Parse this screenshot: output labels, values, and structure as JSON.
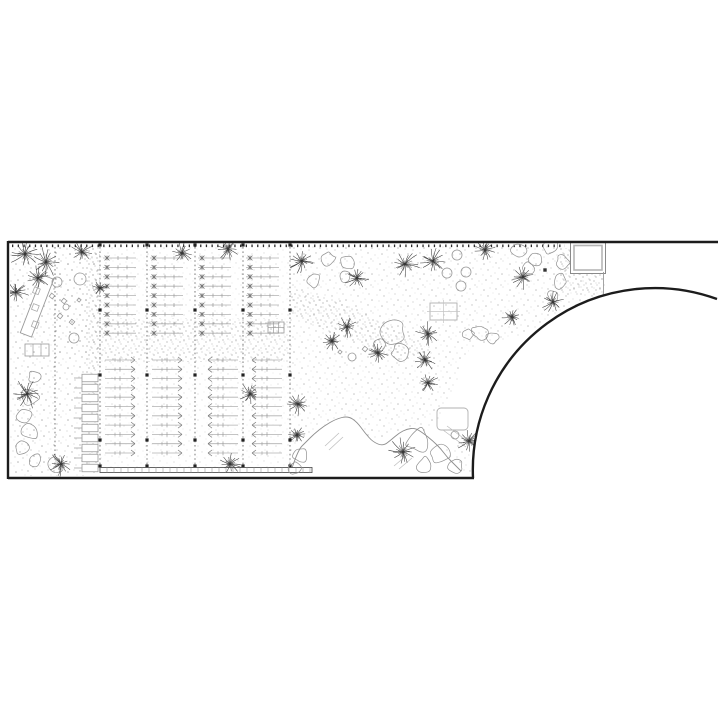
{
  "meta": {
    "description": "monochrome landscape architecture site plan, line drawing, no text labels",
    "canvas": {
      "w": 720,
      "h": 720
    },
    "colors": {
      "background": "#ffffff",
      "boundary": "#1c1c1c",
      "line_mid": "#5a5a5a",
      "line_light": "#9a9a9a",
      "twig": "#b0b0b0",
      "tree": "#3c3c3c",
      "cloud": "#8f8f8f",
      "stipple": "#4a4a4a",
      "structure": "#9a9a9a"
    }
  },
  "plan": {
    "boundary": {
      "stroke_width": 2.4,
      "top": {
        "x1": 8,
        "y1": 242,
        "x2": 718,
        "y2": 242
      },
      "left": {
        "x1": 8,
        "y1": 241,
        "x2": 8,
        "y2": 479
      },
      "bottom": {
        "x1": 8,
        "y1": 478,
        "x2": 474,
        "y2": 478
      },
      "arc_path": "M473,478 A182 182 0 0 1 717,299",
      "clip_path": "M10,243 L717,243 L717,298 A182 182 0 0 0 473,477 L10,477 Z"
    },
    "tick_lines": [
      {
        "x1": 12,
        "y": 245.8,
        "x2": 565
      },
      {
        "x1": 12,
        "y": 480.6,
        "x2": 465
      }
    ],
    "guide_lines": {
      "xs": [
        55,
        100,
        147,
        195,
        243,
        290
      ],
      "y1": 247,
      "y2": 467
    },
    "line_nodes": {
      "xs": [
        100,
        147,
        195,
        243,
        290
      ],
      "ys": [
        245,
        310,
        375,
        440,
        466
      ]
    },
    "plant_rows_upper": {
      "y_start": 258,
      "rows": 9,
      "step": 9.4,
      "len": 33,
      "cols": [
        {
          "x": 103
        },
        {
          "x": 150
        },
        {
          "x": 198
        },
        {
          "x": 246
        }
      ]
    },
    "plant_rows_lower": {
      "y_start": 360,
      "rows": 11,
      "step": 9.3,
      "len": 30,
      "cols": [
        {
          "x": 105,
          "dir": 1
        },
        {
          "x": 152,
          "dir": 1
        },
        {
          "x": 208,
          "dir": -1
        },
        {
          "x": 252,
          "dir": -1
        }
      ]
    },
    "planter_boxes": {
      "x": 82,
      "w": 16,
      "h": 7.5,
      "y_start": 378,
      "count": 10,
      "step": 10,
      "stem": 8
    },
    "boardwalk": {
      "x": 100,
      "y": 467.5,
      "w": 212,
      "h": 5,
      "tick_step": 7
    },
    "square_structure": {
      "x": 572,
      "y": 243.5,
      "w": 32,
      "h": 28.5,
      "drop_x": 603.5,
      "drop_y1": 272,
      "drop_y2": 295
    },
    "ramp": {
      "cx": 37,
      "cy": 306,
      "w": 12,
      "len": 62,
      "angle": 21,
      "inner_squares": [
        [
          31,
          292
        ],
        [
          36,
          308
        ],
        [
          42,
          324
        ]
      ]
    },
    "grids": [
      {
        "x": 25,
        "y": 344,
        "w": 24,
        "h": 12,
        "cols": 3,
        "rows": 1
      },
      {
        "x": 268,
        "y": 322,
        "w": 16,
        "h": 11,
        "cols": 3,
        "rows": 2
      }
    ],
    "rects": [
      {
        "x": 430,
        "y": 303,
        "w": 27,
        "h": 17,
        "cross": true,
        "rx": 0
      },
      {
        "x": 437,
        "y": 408,
        "w": 31,
        "h": 22,
        "cross": false,
        "rx": 4
      }
    ],
    "trees": [
      [
        25,
        254,
        13
      ],
      [
        46,
        262,
        12
      ],
      [
        38,
        278,
        10
      ],
      [
        16,
        292,
        11
      ],
      [
        82,
        252,
        9
      ],
      [
        100,
        288,
        7
      ],
      [
        182,
        253,
        9
      ],
      [
        228,
        249,
        9
      ],
      [
        302,
        261,
        11
      ],
      [
        357,
        278,
        10
      ],
      [
        405,
        264,
        12
      ],
      [
        433,
        261,
        11
      ],
      [
        485,
        250,
        10
      ],
      [
        523,
        277,
        10
      ],
      [
        553,
        302,
        10
      ],
      [
        512,
        317,
        8
      ],
      [
        347,
        327,
        9
      ],
      [
        332,
        341,
        8
      ],
      [
        428,
        334,
        10
      ],
      [
        425,
        360,
        9
      ],
      [
        378,
        353,
        8
      ],
      [
        250,
        394,
        9
      ],
      [
        298,
        404,
        10
      ],
      [
        297,
        435,
        7
      ],
      [
        403,
        452,
        12
      ],
      [
        469,
        441,
        10
      ],
      [
        428,
        383,
        9
      ],
      [
        230,
        464,
        9
      ],
      [
        61,
        464,
        10
      ],
      [
        27,
        394,
        12
      ]
    ],
    "clouds": [
      [
        328,
        259,
        7
      ],
      [
        348,
        262,
        7
      ],
      [
        313,
        280,
        7
      ],
      [
        345,
        277,
        6
      ],
      [
        520,
        250,
        8
      ],
      [
        536,
        258,
        7
      ],
      [
        551,
        247,
        7
      ],
      [
        563,
        262,
        7
      ],
      [
        528,
        268,
        6
      ],
      [
        560,
        281,
        7
      ],
      [
        553,
        296,
        6
      ],
      [
        480,
        332,
        8
      ],
      [
        492,
        338,
        6
      ],
      [
        468,
        334,
        6
      ],
      [
        393,
        331,
        12
      ],
      [
        400,
        352,
        8
      ],
      [
        380,
        345,
        7
      ],
      [
        418,
        440,
        12
      ],
      [
        440,
        455,
        10
      ],
      [
        455,
        466,
        8
      ],
      [
        425,
        465,
        8
      ],
      [
        300,
        455,
        8
      ],
      [
        295,
        468,
        6
      ],
      [
        35,
        377,
        7
      ],
      [
        30,
        398,
        9
      ],
      [
        24,
        415,
        7
      ],
      [
        30,
        432,
        8
      ],
      [
        22,
        448,
        7
      ],
      [
        35,
        460,
        7
      ],
      [
        55,
        466,
        8
      ]
    ],
    "circles": [
      [
        57,
        282,
        5
      ],
      [
        80,
        279,
        6
      ],
      [
        74,
        338,
        5
      ],
      [
        66,
        307,
        3
      ],
      [
        457,
        255,
        5
      ],
      [
        447,
        273,
        5
      ],
      [
        466,
        272,
        5
      ],
      [
        461,
        286,
        5
      ],
      [
        455,
        435,
        4
      ],
      [
        352,
        357,
        4
      ]
    ],
    "diamonds": [
      [
        52,
        296,
        4
      ],
      [
        64,
        301,
        4
      ],
      [
        60,
        316,
        4
      ],
      [
        72,
        322,
        4
      ],
      [
        79,
        300,
        3
      ],
      [
        365,
        349,
        4
      ],
      [
        340,
        352,
        3
      ]
    ],
    "dark_squares": [
      [
        545,
        270
      ]
    ],
    "ridge": {
      "points": [
        [
          292,
          468
        ],
        [
          298,
          450
        ],
        [
          306,
          442
        ],
        [
          314,
          434
        ],
        [
          324,
          426
        ],
        [
          336,
          419
        ],
        [
          348,
          416
        ],
        [
          357,
          422
        ],
        [
          365,
          433
        ],
        [
          373,
          442
        ],
        [
          383,
          446
        ],
        [
          391,
          440
        ],
        [
          399,
          433
        ],
        [
          407,
          429
        ],
        [
          415,
          428
        ],
        [
          423,
          433
        ],
        [
          433,
          441
        ],
        [
          441,
          449
        ],
        [
          447,
          457
        ],
        [
          453,
          463
        ],
        [
          459,
          469
        ],
        [
          463,
          473
        ]
      ],
      "close_y": 477
    },
    "clearing_lines": [
      [
        325,
        446,
        339,
        433
      ],
      [
        329,
        450,
        343,
        437
      ],
      [
        394,
        466,
        407,
        455
      ],
      [
        399,
        469,
        412,
        458
      ]
    ],
    "hatch_lines": [
      [
        443,
        430,
        466,
        447
      ],
      [
        447,
        426,
        470,
        443
      ]
    ],
    "dashed_arc": "M486,412 A14 14 0 0 1 500,398",
    "stipple_zones": [
      {
        "type": "rect",
        "x": 10,
        "y": 246,
        "w": 90,
        "h": 230,
        "o": 0.4,
        "dense": false
      },
      {
        "type": "rect",
        "x": 86,
        "y": 246,
        "w": 14,
        "h": 221,
        "o": 0.55,
        "dense": true
      },
      {
        "type": "rect",
        "x": 100,
        "y": 246,
        "w": 190,
        "h": 226,
        "o": 0.16,
        "dense": false
      },
      {
        "type": "rect",
        "x": 100,
        "y": 318,
        "w": 190,
        "h": 44,
        "o": 0.5,
        "dense": true
      },
      {
        "type": "poly",
        "points": "290,246 605,246 605,296 540,330 470,348 458,380 440,420 418,437 400,430 372,441 348,416 322,427 296,450 290,452",
        "o": 0.32,
        "dense": false
      },
      {
        "type": "poly",
        "points": "290,288 340,300 410,335 432,352 400,362 330,332 290,316",
        "o": 0.5,
        "dense": true
      },
      {
        "type": "rect",
        "x": 560,
        "y": 248,
        "w": 43,
        "h": 47,
        "o": 0.5,
        "dense": true
      },
      {
        "type": "rect",
        "x": 55,
        "y": 250,
        "w": 45,
        "h": 105,
        "o": 0.18,
        "dense": false
      },
      {
        "type": "poly",
        "points": "440,448 468,442 471,472 442,470",
        "o": 0.3,
        "dense": false
      }
    ]
  }
}
